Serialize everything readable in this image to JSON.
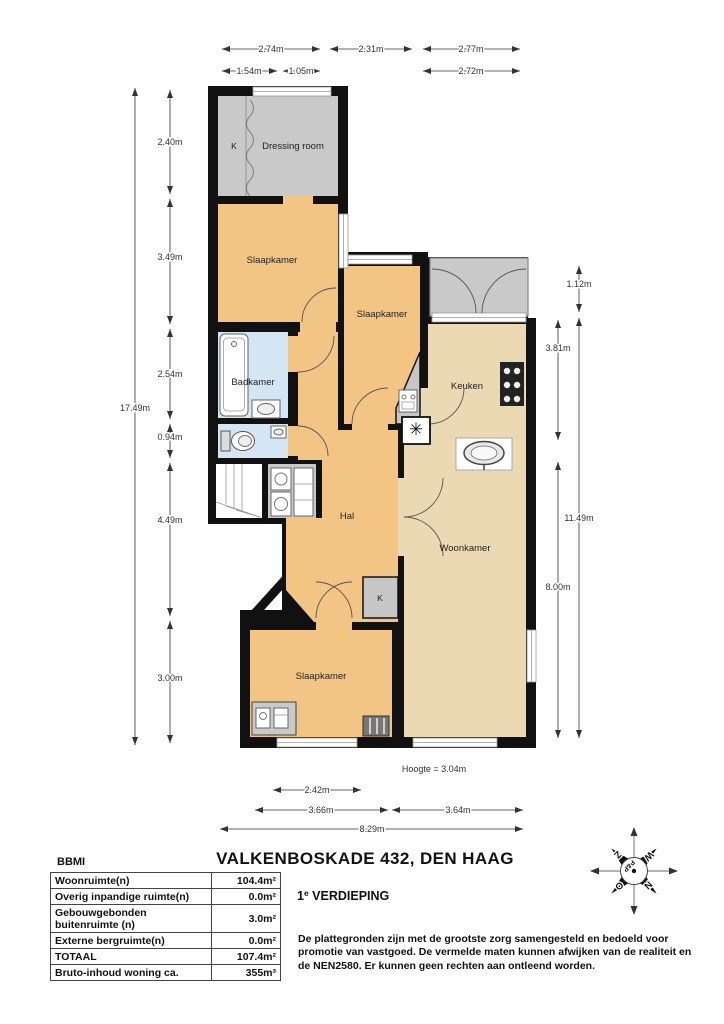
{
  "colors": {
    "wall": "#111111",
    "room_orange": "#f2c584",
    "room_tan": "#ebd9b4",
    "room_gray": "#c9c9c9",
    "room_blue": "#d4e6f3"
  },
  "plan": {
    "rooms": {
      "dressing_room": "Dressing room",
      "slaapkamer_1": "Slaapkamer",
      "slaapkamer_2": "Slaapkamer",
      "slaapkamer_3": "Slaapkamer",
      "badkamer": "Badkamer",
      "keuken": "Keuken",
      "hal": "Hal",
      "woonkamer": "Woonkamer",
      "kast_dressing": "K",
      "kast_hal": "K"
    },
    "icons": {
      "vent": "✳"
    }
  },
  "dims": {
    "top_row1": [
      "2.74m",
      "2.31m",
      "2.77m"
    ],
    "top_row2": [
      "1.54m",
      "1.05m",
      "2.72m"
    ],
    "left_total": "17.49m",
    "left_segments": [
      "2.40m",
      "3.49m",
      "2.54m",
      "0.94m",
      "4.49m",
      "3.00m"
    ],
    "right_inner": [
      "3.81m",
      "8.00m"
    ],
    "right_outer": [
      "1.12m",
      "11.49m"
    ],
    "bottom_row1": "2.42m",
    "bottom_row2": [
      "3.66m",
      "3.64m"
    ],
    "bottom_total": "8.29m",
    "height_note": "Hoogte = 3.04m"
  },
  "header": {
    "title": "VALKENBOSKADE 432, DEN HAAG",
    "floor_number": "1",
    "floor_sup": "e",
    "floor_label": "VERDIEPING"
  },
  "summary": {
    "label": "BBMI",
    "rows": [
      {
        "label": "Woonruimte(n)",
        "value": "104.4m²"
      },
      {
        "label": "Overig inpandige ruimte(n)",
        "value": "0.0m²"
      },
      {
        "label": "Gebouwgebonden buitenruimte (n)",
        "value": "3.0m²"
      },
      {
        "label": "Externe bergruimte(n)",
        "value": "0.0m²"
      },
      {
        "label": "TOTAAL",
        "value": "107.4m²"
      },
      {
        "label": "Bruto-inhoud woning ca.",
        "value": "355m³"
      }
    ]
  },
  "disclaimer": "De plattegronden zijn met de grootste zorg samengesteld en bedoeld voor promotie van vastgoed. De vermelde maten kunnen afwijken van de realiteit en de NEN2580. Er kunnen geen rechten aan ontleend worden.",
  "compass": {
    "n": "N",
    "o": "O",
    "z": "Z",
    "w": "W",
    "center": "P&P"
  }
}
